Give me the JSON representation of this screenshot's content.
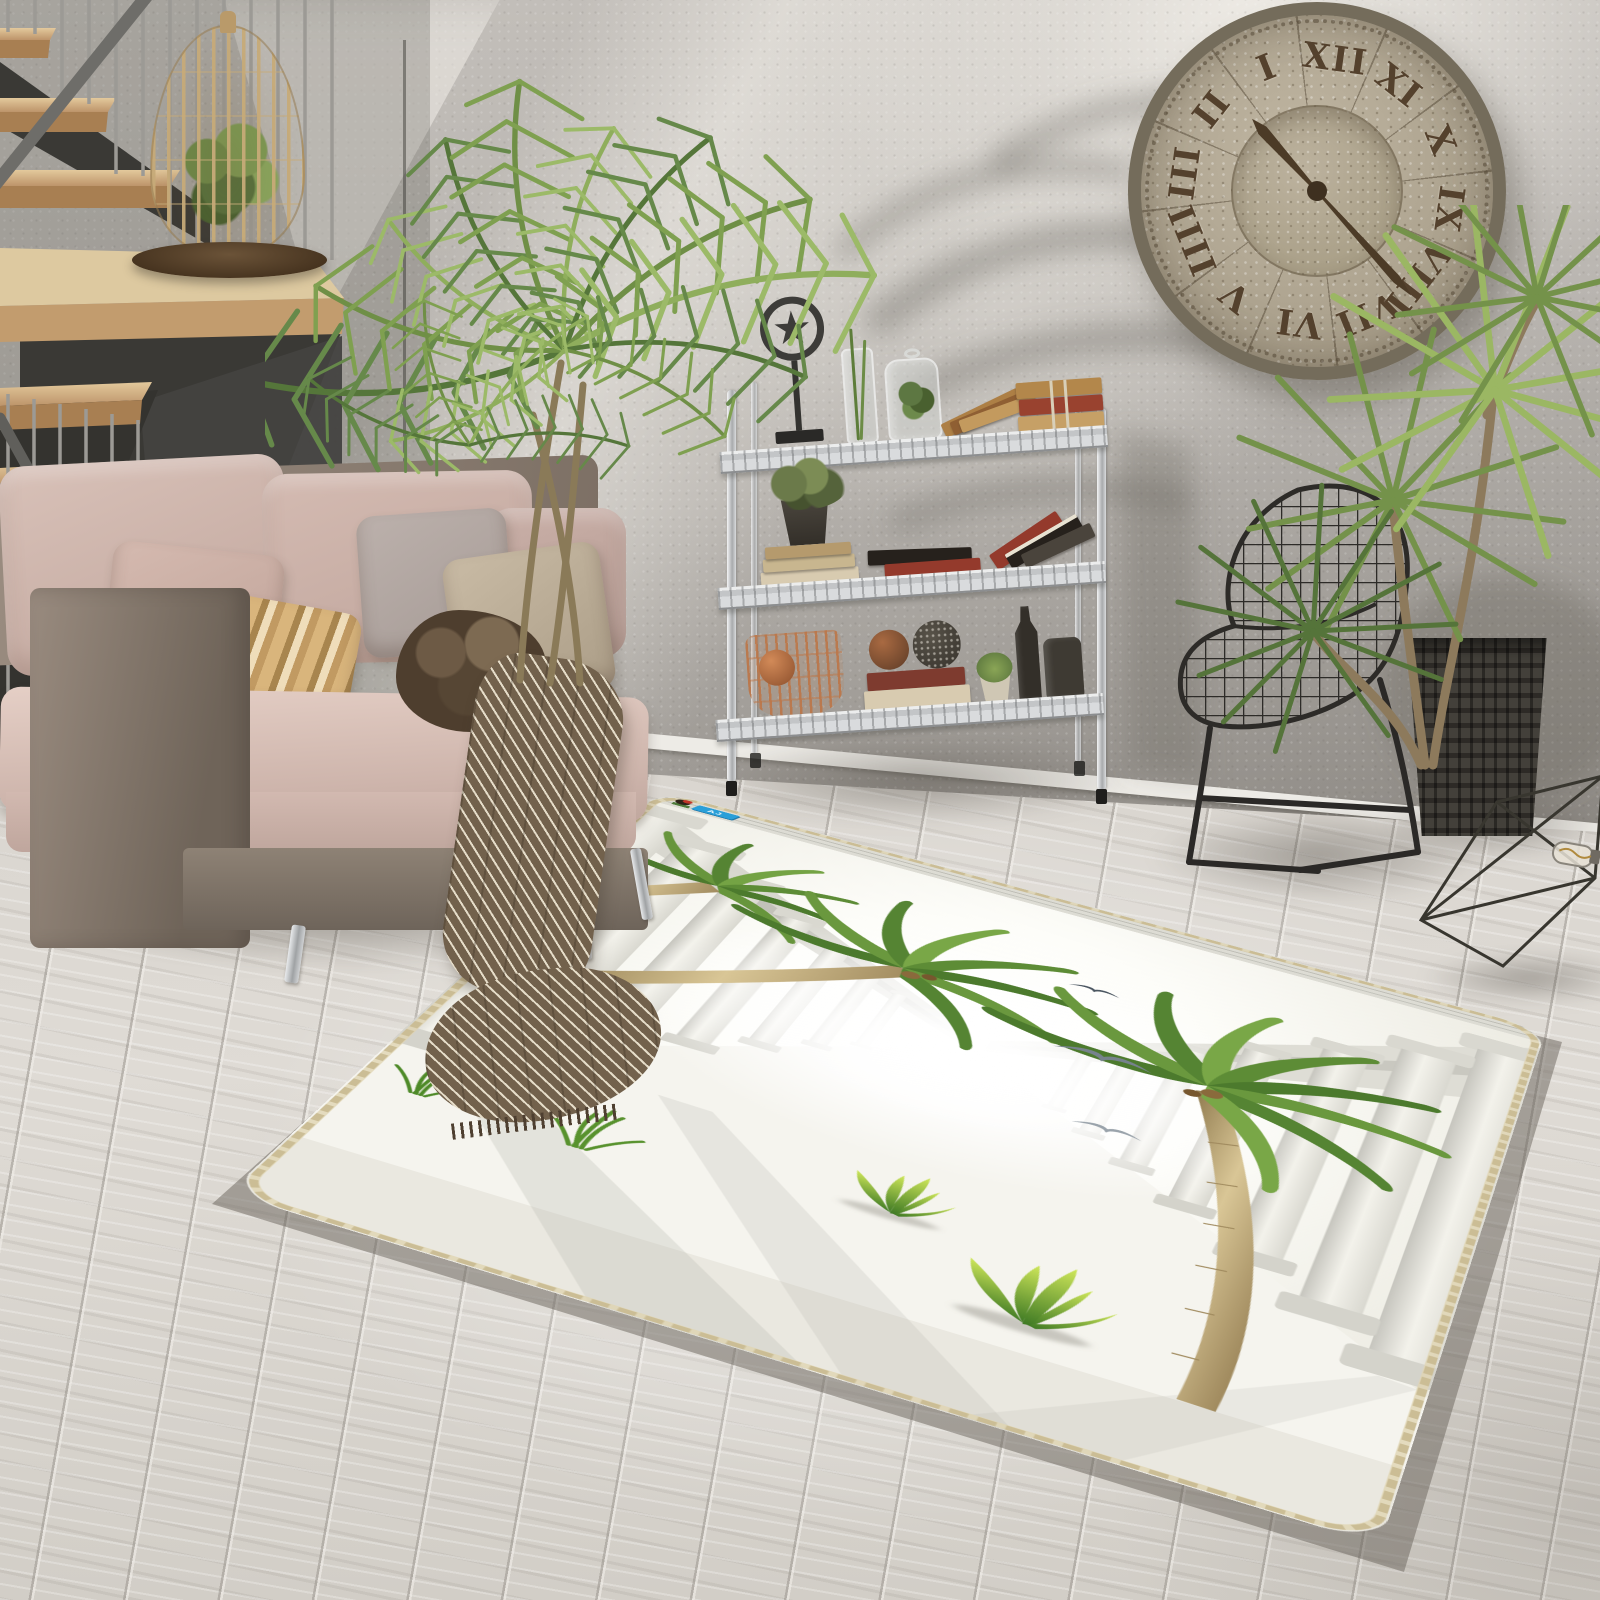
{
  "image": {
    "domain": "natural photograph",
    "subject": "Product photo of a 3D tropical colonnade print area rug styled in a gray living room"
  },
  "colors": {
    "wall": "#b7b3ae",
    "wall-light": "#e3e0da",
    "wall-dark": "#6e6a64",
    "floor": "#dbd7d1",
    "plank-line": "#948f88",
    "baseboard": "#edebe6",
    "wood": "#d6b483",
    "wood-dark": "#b08353",
    "stringer": "#35342f",
    "rail": "#97958f",
    "chrome": "#c9cbcd",
    "sofa-frame": "#857869",
    "sofa-frame-dark": "#6b6054",
    "cushion": "#d0b7ae",
    "pillow-gold": "#c49d63",
    "pillow-gray": "#b3a8a3",
    "pillow-beige": "#c0b29c",
    "throw": "#756550",
    "throw-light": "#e7dec9",
    "clock-face": "#b2a892",
    "clock-marks": "#54412d",
    "clock-rim": "#746c5b",
    "chair-wire": "#2d2b28",
    "planter-woven": "#37342f",
    "planter-concrete": "#bdb5a5",
    "leaf": "#6f9148",
    "leaf-dark": "#4c6b33",
    "leaf-light": "#9cba68",
    "rug-base": "#f4f3ed",
    "rug-border": "#cbbd95",
    "column": "#e2e1d9",
    "trunk": "#b3995f",
    "book-tan": "#ad7f45",
    "book-red": "#943a2c",
    "book-dark": "#26211c",
    "book-cream": "#d8cbb0",
    "copper": "#b06f45",
    "logo-blue": "#2a9fd8"
  },
  "clock": {
    "numerals": [
      "XII",
      "I",
      "II",
      "III",
      "IIII",
      "V",
      "VI",
      "VII",
      "VIII",
      "IX",
      "X",
      "XI"
    ],
    "numeral_order": "counterclockwise (mirrored face)",
    "top_numeral_angle_deg": 8,
    "hour_hand_angle_deg": -42,
    "minute_hand_angle_deg": 138,
    "style": "oversized rustic riveted metal clock with radial roman numerals"
  },
  "rug": {
    "shape": "rectangle with rounded corners, lying in floor perspective",
    "border": "beige stitched overlock edge",
    "print": {
      "scene": "white classical colonnade corridor receding to a bright glowing sky",
      "palm_trees": 3,
      "seagulls": 3,
      "green_sprouts": 3,
      "grass_tufts": 2
    },
    "logo": {
      "mascot": "girl with red cap",
      "text": "AJ",
      "badge_color": "#2a9fd8"
    }
  },
  "room": {
    "stairs": {
      "treads": "light wood",
      "structure": "black steel stringer",
      "balusters": "thin steel rods",
      "decor": "rattan teardrop cage planter on landing"
    },
    "sofa": {
      "frame": "brown tweed",
      "cushions": "blush velvet",
      "pillows": [
        "blush",
        "gold striped",
        "gray",
        "beige"
      ],
      "throw": "brown herringbone with fringe"
    },
    "plants": [
      "kentia palm in concrete cube pot",
      "dracaena in dark woven pot",
      "greens in rattan cage"
    ],
    "shelf": {
      "type": "3-tier chrome wire shelving",
      "items": [
        "star-in-ring sculpture",
        "glass vase with lucky bamboo",
        "glass cloche jar with greens",
        "leaning tan books",
        "tied book bundle",
        "potted plant on book stack",
        "flat dark book",
        "flat red book",
        "leaning red and black books",
        "copper wire basket with copper spheres",
        "rust and mesh decor balls",
        "book stack",
        "small succulent",
        "two dark glass bottles"
      ]
    },
    "chair": "black wire mesh side chair",
    "decor": "geometric wire prism with filament bulb on floor",
    "floor": "whitewashed wide wood planks",
    "wall": "gray textured plaster with soft palm-frond shadows"
  }
}
